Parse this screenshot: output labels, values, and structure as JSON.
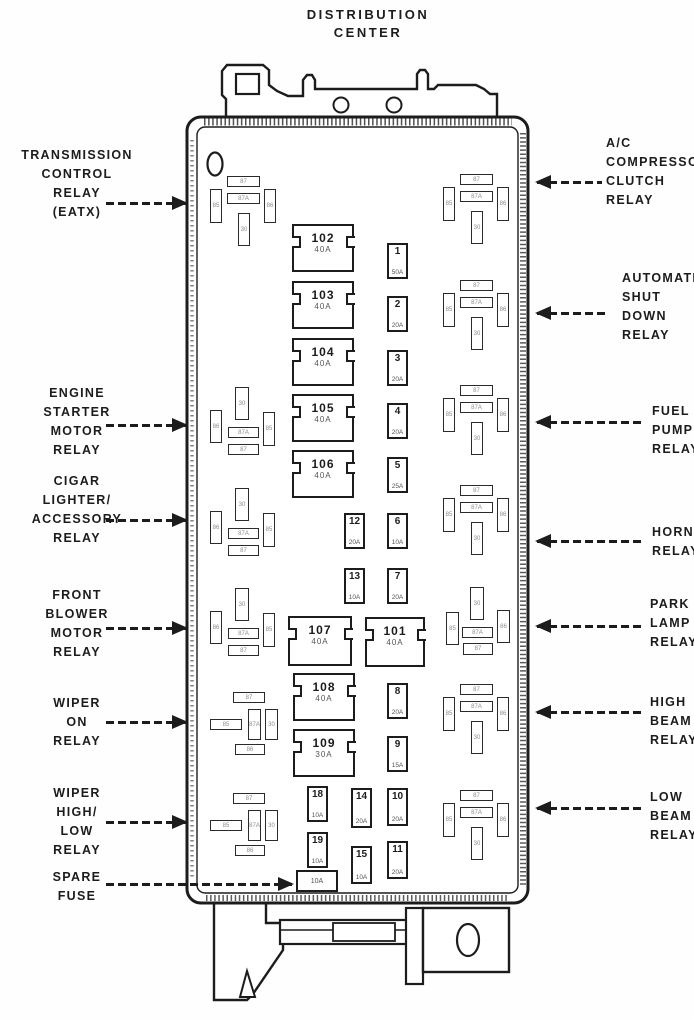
{
  "title": {
    "line1": "DISTRIBUTION",
    "line2": "CENTER"
  },
  "colors": {
    "ink": "#1c1c1c",
    "background": "#ffffff",
    "amp_text": "#555555"
  },
  "labels": {
    "left": [
      {
        "id": "transmission-control-relay",
        "lines": [
          "TRANSMISSION",
          "CONTROL",
          "RELAY",
          "(EATX)"
        ],
        "top": 146,
        "arrow": {
          "x1": 106,
          "x2": 186,
          "y": 203
        }
      },
      {
        "id": "engine-starter-motor-relay",
        "lines": [
          "ENGINE",
          "STARTER",
          "MOTOR",
          "RELAY"
        ],
        "top": 384,
        "arrow": {
          "x1": 106,
          "x2": 186,
          "y": 425
        }
      },
      {
        "id": "cigar-lighter-accessory-relay",
        "lines": [
          "CIGAR",
          "LIGHTER/",
          "ACCESSORY",
          "RELAY"
        ],
        "top": 472,
        "arrow": {
          "x1": 106,
          "x2": 186,
          "y": 520
        }
      },
      {
        "id": "front-blower-motor-relay",
        "lines": [
          "FRONT",
          "BLOWER",
          "MOTOR",
          "RELAY"
        ],
        "top": 586,
        "arrow": {
          "x1": 106,
          "x2": 186,
          "y": 628
        }
      },
      {
        "id": "wiper-on-relay",
        "lines": [
          "WIPER",
          "ON",
          "RELAY"
        ],
        "top": 694,
        "arrow": {
          "x1": 106,
          "x2": 186,
          "y": 722
        }
      },
      {
        "id": "wiper-high-low-relay",
        "lines": [
          "WIPER",
          "HIGH/",
          "LOW",
          "RELAY"
        ],
        "top": 784,
        "arrow": {
          "x1": 106,
          "x2": 186,
          "y": 822
        }
      },
      {
        "id": "spare-fuse",
        "lines": [
          "SPARE",
          "FUSE"
        ],
        "top": 868,
        "arrow": {
          "x1": 106,
          "x2": 292,
          "y": 884
        }
      }
    ],
    "right": [
      {
        "id": "ac-compressor-clutch-relay",
        "lines": [
          "A/C",
          "COMPRESSOR",
          "CLUTCH",
          "RELAY"
        ],
        "left": 606,
        "top": 134,
        "arrow": {
          "x1": 537,
          "x2": 602,
          "y": 182
        }
      },
      {
        "id": "automatic-shut-down-relay",
        "lines": [
          "AUTOMATIC",
          "SHUT",
          "DOWN",
          "RELAY"
        ],
        "left": 622,
        "top": 269,
        "arrow": {
          "x1": 537,
          "x2": 606,
          "y": 313
        }
      },
      {
        "id": "fuel-pump-relay",
        "lines": [
          "FUEL",
          "PUMP",
          "RELAY"
        ],
        "left": 652,
        "top": 402,
        "arrow": {
          "x1": 537,
          "x2": 645,
          "y": 422
        }
      },
      {
        "id": "horn-relay",
        "lines": [
          "HORN",
          "RELAY"
        ],
        "left": 652,
        "top": 523,
        "arrow": {
          "x1": 537,
          "x2": 645,
          "y": 541
        }
      },
      {
        "id": "park-lamp-relay",
        "lines": [
          "PARK",
          "LAMP",
          "RELAY"
        ],
        "left": 650,
        "top": 595,
        "arrow": {
          "x1": 537,
          "x2": 645,
          "y": 626
        }
      },
      {
        "id": "high-beam-relay",
        "lines": [
          "HIGH",
          "BEAM",
          "RELAY"
        ],
        "left": 650,
        "top": 693,
        "arrow": {
          "x1": 537,
          "x2": 645,
          "y": 712
        }
      },
      {
        "id": "low-beam-relay",
        "lines": [
          "LOW",
          "BEAM",
          "RELAY"
        ],
        "left": 650,
        "top": 788,
        "arrow": {
          "x1": 537,
          "x2": 645,
          "y": 808
        }
      }
    ]
  },
  "fuses": {
    "large": [
      {
        "id": "102",
        "amp": "40A",
        "x": 292,
        "y": 224
      },
      {
        "id": "103",
        "amp": "40A",
        "x": 292,
        "y": 281
      },
      {
        "id": "104",
        "amp": "40A",
        "x": 292,
        "y": 338
      },
      {
        "id": "105",
        "amp": "40A",
        "x": 292,
        "y": 394
      },
      {
        "id": "106",
        "amp": "40A",
        "x": 292,
        "y": 450
      },
      {
        "id": "107",
        "amp": "40A",
        "x": 288,
        "y": 616,
        "w": 64,
        "h": 50
      },
      {
        "id": "101",
        "amp": "40A",
        "x": 365,
        "y": 617,
        "w": 60,
        "h": 50
      },
      {
        "id": "108",
        "amp": "40A",
        "x": 293,
        "y": 673
      },
      {
        "id": "109",
        "amp": "30A",
        "x": 293,
        "y": 729
      }
    ],
    "small": [
      {
        "id": "1",
        "amp": "50A",
        "x": 387,
        "y": 243
      },
      {
        "id": "2",
        "amp": "20A",
        "x": 387,
        "y": 296
      },
      {
        "id": "3",
        "amp": "20A",
        "x": 387,
        "y": 350
      },
      {
        "id": "4",
        "amp": "20A",
        "x": 387,
        "y": 403
      },
      {
        "id": "5",
        "amp": "25A",
        "x": 387,
        "y": 457
      },
      {
        "id": "12",
        "amp": "20A",
        "x": 344,
        "y": 513
      },
      {
        "id": "6",
        "amp": "10A",
        "x": 387,
        "y": 513
      },
      {
        "id": "13",
        "amp": "10A",
        "x": 344,
        "y": 568
      },
      {
        "id": "7",
        "amp": "20A",
        "x": 387,
        "y": 568
      },
      {
        "id": "8",
        "amp": "20A",
        "x": 387,
        "y": 683
      },
      {
        "id": "9",
        "amp": "15A",
        "x": 387,
        "y": 736
      },
      {
        "id": "18",
        "amp": "10A",
        "x": 307,
        "y": 786
      },
      {
        "id": "14",
        "amp": "20A",
        "x": 351,
        "y": 788,
        "h": 40
      },
      {
        "id": "10",
        "amp": "20A",
        "x": 387,
        "y": 788,
        "h": 38
      },
      {
        "id": "19",
        "amp": "10A",
        "x": 307,
        "y": 832
      },
      {
        "id": "15",
        "amp": "10A",
        "x": 351,
        "y": 846,
        "h": 38
      },
      {
        "id": "11",
        "amp": "20A",
        "x": 387,
        "y": 841,
        "h": 38
      }
    ],
    "spare": {
      "id": "spare",
      "amp": "10A",
      "x": 296,
      "y": 870
    }
  },
  "relays": {
    "layouts": {
      "tee": [
        {
          "t": "h",
          "dx": 17,
          "dy": 0,
          "w": 33,
          "h": 11,
          "label": "87"
        },
        {
          "t": "h",
          "dx": 17,
          "dy": 17,
          "w": 33,
          "h": 11,
          "label": "87A"
        },
        {
          "t": "v",
          "dx": 0,
          "dy": 13,
          "w": 12,
          "h": 34,
          "label": "85"
        },
        {
          "t": "v",
          "dx": 54,
          "dy": 13,
          "w": 12,
          "h": 34,
          "label": "86"
        },
        {
          "t": "v",
          "dx": 28,
          "dy": 37,
          "w": 12,
          "h": 33,
          "label": "30"
        }
      ],
      "side": [
        {
          "t": "v",
          "dx": 25,
          "dy": 0,
          "w": 14,
          "h": 33,
          "label": "30"
        },
        {
          "t": "v",
          "dx": 0,
          "dy": 23,
          "w": 12,
          "h": 33,
          "label": "86"
        },
        {
          "t": "h",
          "dx": 18,
          "dy": 40,
          "w": 31,
          "h": 11,
          "label": "87A"
        },
        {
          "t": "h",
          "dx": 18,
          "dy": 57,
          "w": 31,
          "h": 11,
          "label": "87"
        },
        {
          "t": "v",
          "dx": 53,
          "dy": 25,
          "w": 12,
          "h": 34,
          "label": "85"
        }
      ],
      "wiper": [
        {
          "t": "h",
          "dx": 23,
          "dy": 0,
          "w": 32,
          "h": 11,
          "label": "87"
        },
        {
          "t": "h",
          "dx": 0,
          "dy": 27,
          "w": 32,
          "h": 11,
          "label": "85"
        },
        {
          "t": "v",
          "dx": 38,
          "dy": 17,
          "w": 13,
          "h": 31,
          "label": "87A"
        },
        {
          "t": "v",
          "dx": 55,
          "dy": 17,
          "w": 13,
          "h": 31,
          "label": "30"
        },
        {
          "t": "h",
          "dx": 25,
          "dy": 52,
          "w": 30,
          "h": 11,
          "label": "86"
        }
      ],
      "park": [
        {
          "t": "v",
          "dx": 24,
          "dy": 0,
          "w": 14,
          "h": 33,
          "label": "30"
        },
        {
          "t": "v",
          "dx": 0,
          "dy": 25,
          "w": 13,
          "h": 33,
          "label": "85"
        },
        {
          "t": "v",
          "dx": 51,
          "dy": 23,
          "w": 13,
          "h": 33,
          "label": "86"
        },
        {
          "t": "h",
          "dx": 16,
          "dy": 40,
          "w": 31,
          "h": 11,
          "label": "87A"
        },
        {
          "t": "h",
          "dx": 17,
          "dy": 56,
          "w": 30,
          "h": 12,
          "label": "87"
        }
      ]
    },
    "clusters": [
      {
        "id": "transmission-control",
        "layout": "tee",
        "x": 210,
        "y": 176
      },
      {
        "id": "ac-compressor-clutch",
        "layout": "tee",
        "x": 443,
        "y": 174
      },
      {
        "id": "automatic-shut-down",
        "layout": "tee",
        "x": 443,
        "y": 280
      },
      {
        "id": "engine-starter-motor",
        "layout": "side",
        "x": 210,
        "y": 387
      },
      {
        "id": "fuel-pump",
        "layout": "tee",
        "x": 443,
        "y": 385
      },
      {
        "id": "cigar-lighter",
        "layout": "side",
        "x": 210,
        "y": 488
      },
      {
        "id": "horn",
        "layout": "tee",
        "x": 443,
        "y": 485
      },
      {
        "id": "front-blower-motor",
        "layout": "side",
        "x": 210,
        "y": 588
      },
      {
        "id": "park-lamp",
        "layout": "park",
        "x": 446,
        "y": 587
      },
      {
        "id": "wiper-on",
        "layout": "wiper",
        "x": 210,
        "y": 692
      },
      {
        "id": "high-beam",
        "layout": "tee",
        "x": 443,
        "y": 684
      },
      {
        "id": "wiper-high-low",
        "layout": "wiper",
        "x": 210,
        "y": 793
      },
      {
        "id": "low-beam",
        "layout": "tee",
        "x": 443,
        "y": 790
      }
    ]
  }
}
